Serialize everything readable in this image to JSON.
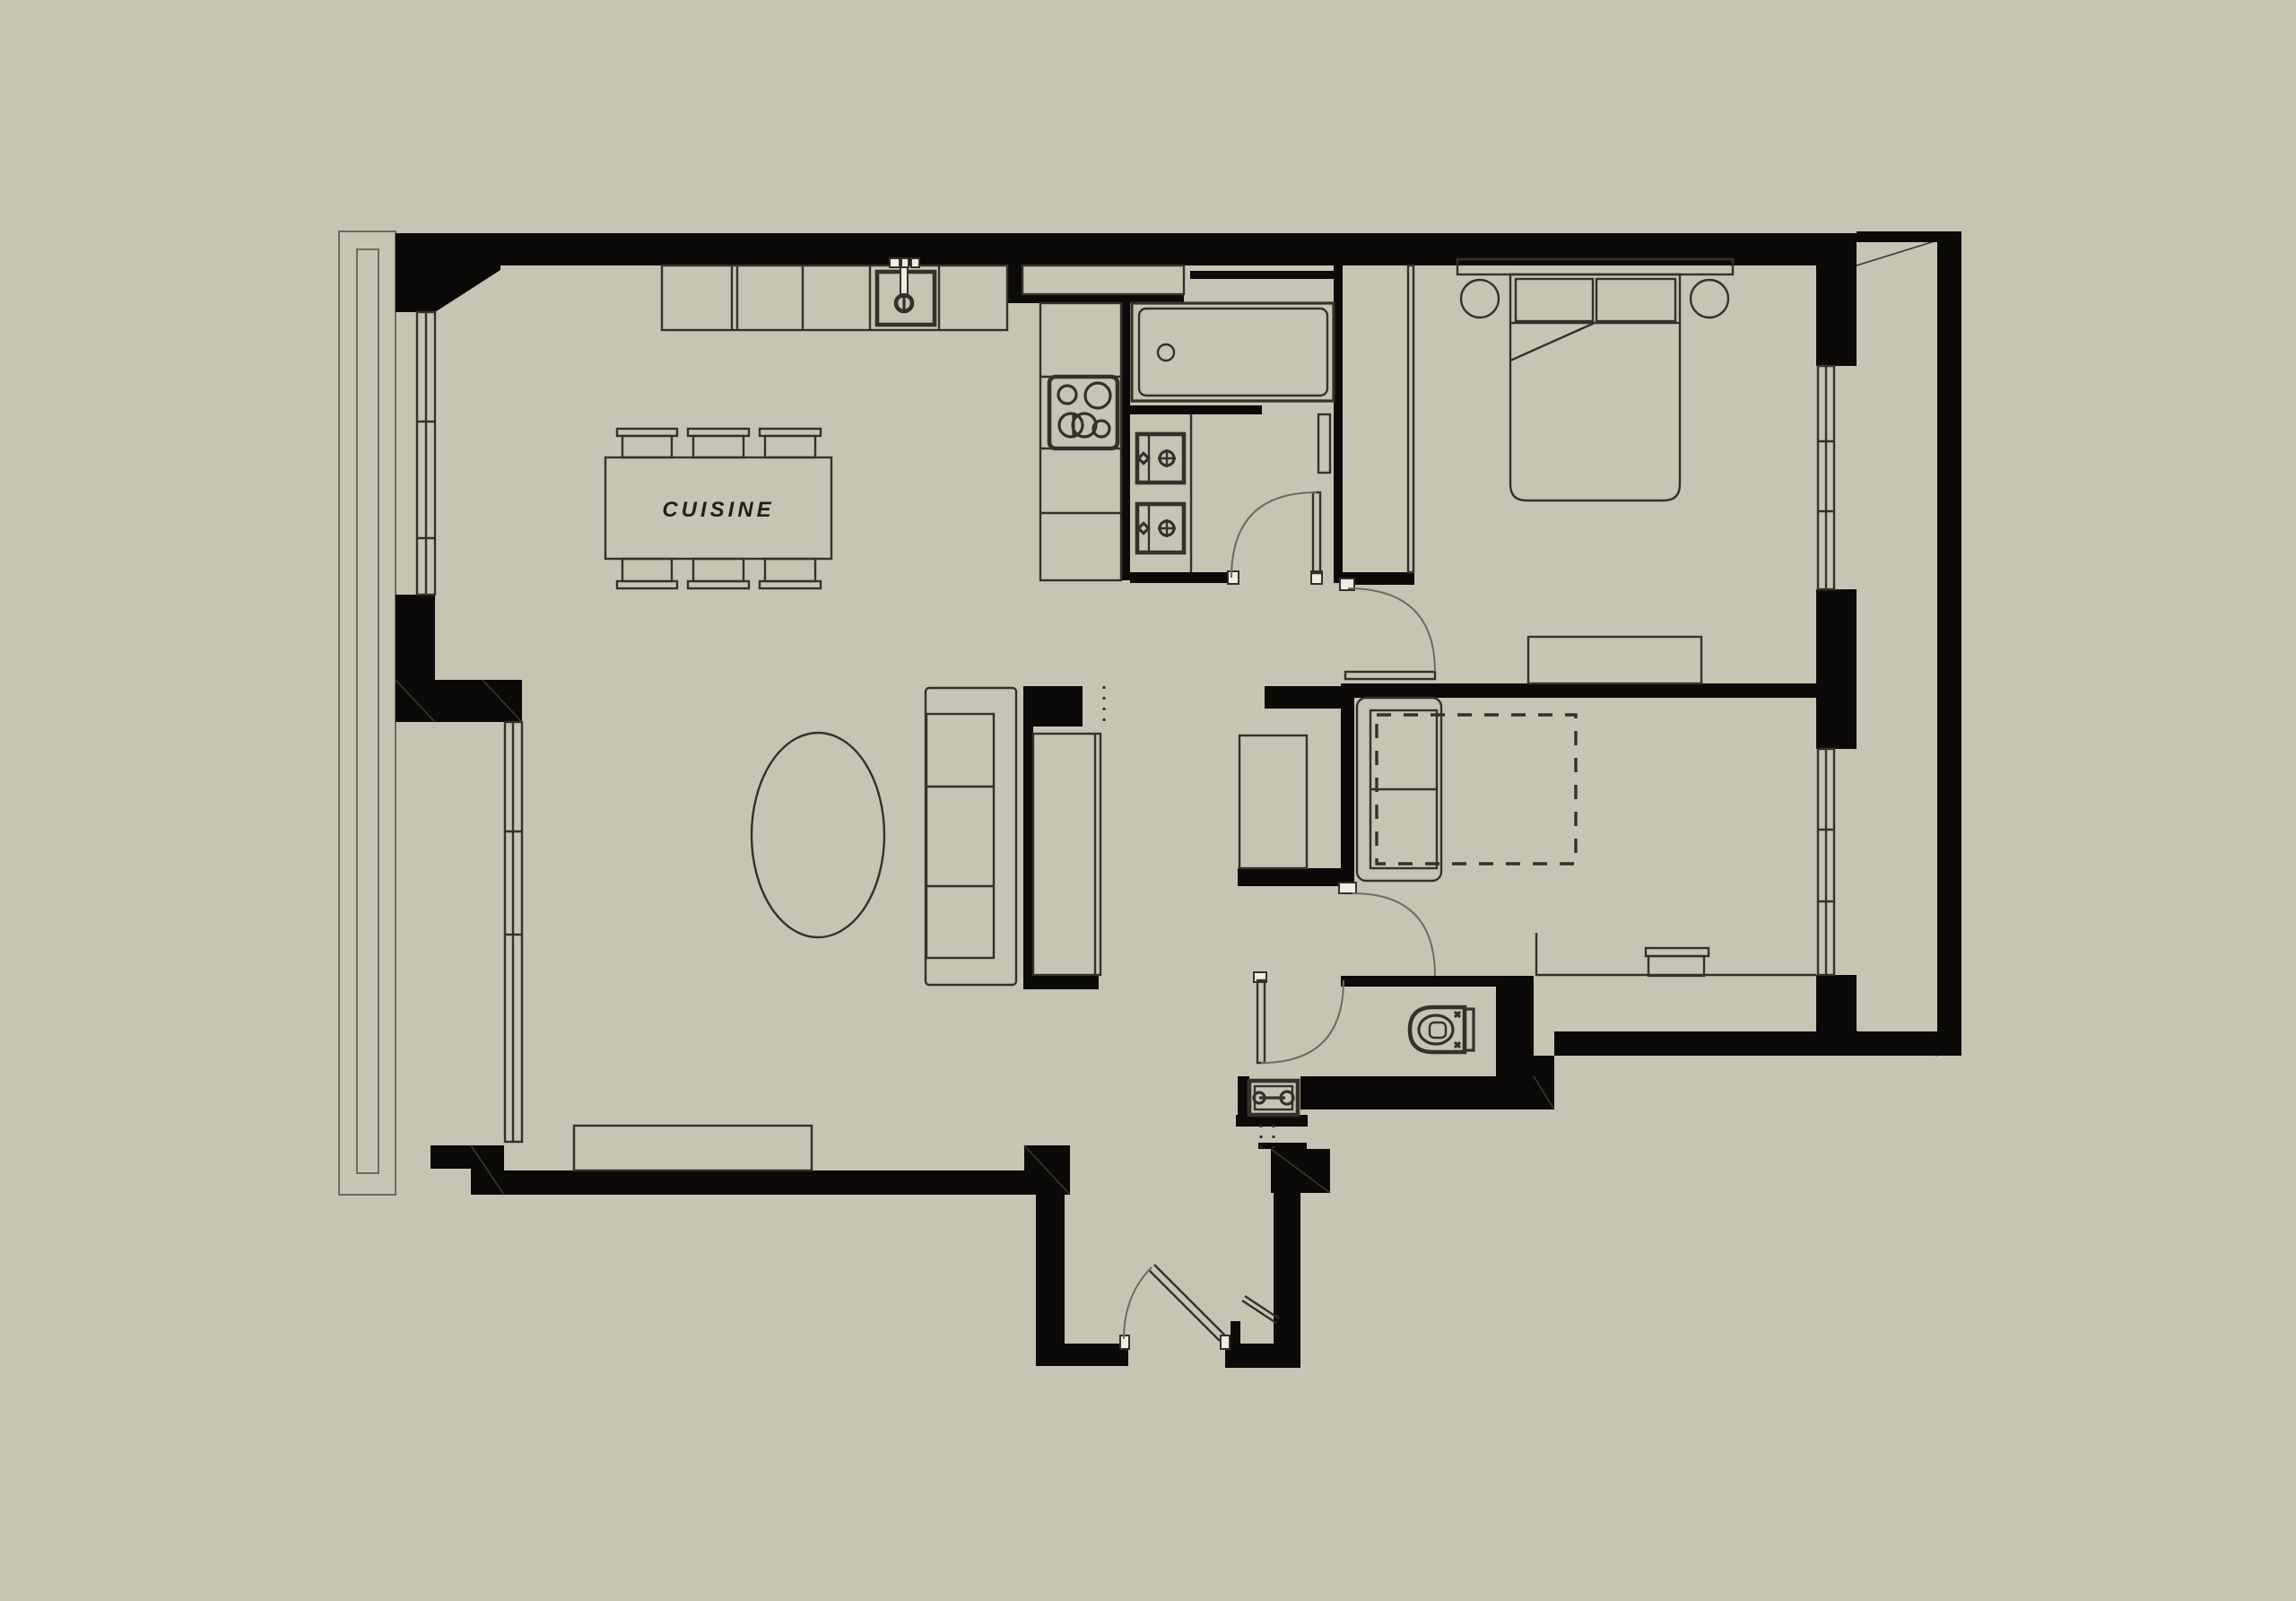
{
  "title": "apartment-floor-plan",
  "labels": {
    "kitchen": "CUISINE"
  },
  "colors": {
    "background": "#c8c4b4",
    "wall": "#0b0a08",
    "line": "#35312a",
    "line_light": "#6f6b5f",
    "paper_white": "#efede4"
  }
}
